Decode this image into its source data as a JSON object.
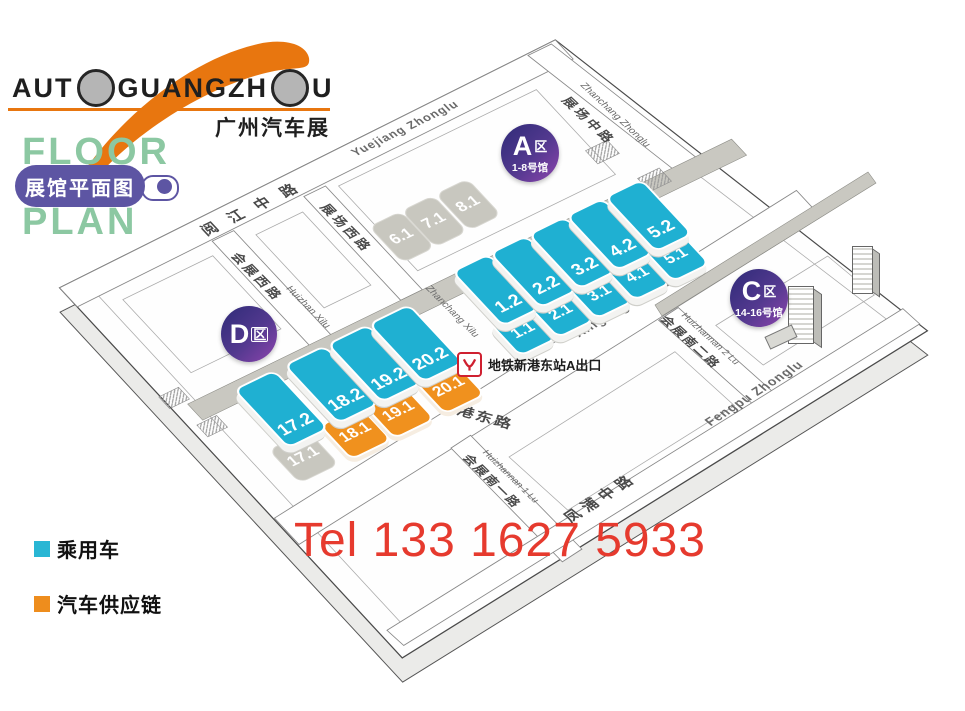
{
  "header": {
    "logo_text_1": "AUT",
    "logo_text_2": "GUANGZH",
    "logo_text_3": "U",
    "logo_cn": "广州汽车展",
    "floor": "FLOOR",
    "plan": "PLAN",
    "floorplan_badge": "展馆平面图"
  },
  "zones": [
    {
      "id": "A",
      "letter": "A",
      "suffix": "区",
      "halls_range": "1-8号馆"
    },
    {
      "id": "C",
      "letter": "C",
      "suffix": "区",
      "halls_range": "14-16号馆"
    },
    {
      "id": "D",
      "letter": "D",
      "suffix": "区",
      "halls_range": ""
    }
  ],
  "halls": [
    {
      "label": "1.1",
      "category": "passenger"
    },
    {
      "label": "1.2",
      "category": "passenger"
    },
    {
      "label": "2.1",
      "category": "passenger"
    },
    {
      "label": "2.2",
      "category": "passenger"
    },
    {
      "label": "3.1",
      "category": "passenger"
    },
    {
      "label": "3.2",
      "category": "passenger"
    },
    {
      "label": "4.1",
      "category": "passenger"
    },
    {
      "label": "4.2",
      "category": "passenger"
    },
    {
      "label": "5.1",
      "category": "passenger"
    },
    {
      "label": "5.2",
      "category": "passenger"
    },
    {
      "label": "6.1",
      "category": "inactive"
    },
    {
      "label": "7.1",
      "category": "inactive"
    },
    {
      "label": "8.1",
      "category": "inactive"
    },
    {
      "label": "17.1",
      "category": "inactive"
    },
    {
      "label": "17.2",
      "category": "passenger"
    },
    {
      "label": "18.1",
      "category": "supply"
    },
    {
      "label": "18.2",
      "category": "passenger"
    },
    {
      "label": "19.1",
      "category": "supply"
    },
    {
      "label": "19.2",
      "category": "passenger"
    },
    {
      "label": "20.1",
      "category": "supply"
    },
    {
      "label": "20.2",
      "category": "passenger"
    }
  ],
  "roads": [
    {
      "id": "yuejiang",
      "cn": "阅 江 中 路",
      "en": "Yuejiang Zhonglu"
    },
    {
      "id": "zhanchang_zhonglu",
      "cn": "展场中路",
      "en": "Zhanchang Zhonglu"
    },
    {
      "id": "huizhan_xilu",
      "cn": "会展西路",
      "en": "Huizhan Xilu"
    },
    {
      "id": "zhanchang_xilu",
      "cn": "展场西路",
      "en": "Zhanchang Xilu"
    },
    {
      "id": "xingang",
      "cn": "新港东路",
      "en": "Xingang Donglu"
    },
    {
      "id": "huizhannan1",
      "cn": "会展南一路",
      "en": "Huizhannan 1 Lu"
    },
    {
      "id": "huizhannan2",
      "cn": "会展南二路",
      "en": "Huizhannan 2 Lu"
    },
    {
      "id": "fengpu",
      "cn": "凤浦中路",
      "en": "Fengpu Zhonglu"
    }
  ],
  "metro": {
    "label": "地铁新港东站A出口"
  },
  "legend": [
    {
      "label": "乘用车",
      "color": "#29b6d4"
    },
    {
      "label": "汽车供应链",
      "color": "#ee8d1d"
    }
  ],
  "contact": {
    "tel": "Tel 133 1627 5933"
  },
  "colors": {
    "passenger_hall": "#1fb0d2",
    "supply_hall": "#f0911e",
    "inactive_hall": "#c8c7bf",
    "zone_badge_from": "#2f2b78",
    "zone_badge_to": "#8d44ad",
    "brand_orange": "#e8760f",
    "floorplan_green": "#8cc8a2",
    "floorplan_purple": "#5d55a3",
    "tel_red": "#e63a2e",
    "metro_red": "#cf2030"
  }
}
